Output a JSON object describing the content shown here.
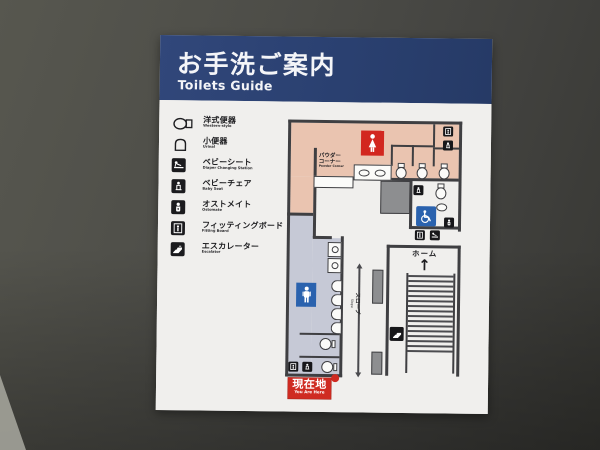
{
  "sign": {
    "title": "お手洗ご案内",
    "subtitle": "Toilets Guide"
  },
  "legend": {
    "items": [
      {
        "jp": "洋式便器",
        "en": "Western-style",
        "icon": "western-toilet-icon"
      },
      {
        "jp": "小便器",
        "en": "Urinal",
        "icon": "urinal-icon"
      },
      {
        "jp": "ベビーシート",
        "en": "Diaper Changing Station",
        "icon": "diaper-changing-icon"
      },
      {
        "jp": "ベビーチェア",
        "en": "Baby Seat",
        "icon": "baby-seat-icon"
      },
      {
        "jp": "オストメイト",
        "en": "Ostomate",
        "icon": "ostomate-icon"
      },
      {
        "jp": "フィッティングボード",
        "en": "Fitting Board",
        "icon": "fitting-board-icon"
      },
      {
        "jp": "エスカレーター",
        "en": "Escalator",
        "icon": "escalator-icon"
      }
    ]
  },
  "map": {
    "powder_corner": {
      "jp_line1": "パウダー",
      "jp_line2": "コーナー",
      "en": "Powder Corner"
    },
    "platform": {
      "label": "ホーム",
      "arrow": "↑"
    },
    "slope": {
      "jp": "スロープ",
      "en": "Slope"
    },
    "you_are_here": {
      "jp": "現在地",
      "en": "You Are Here"
    },
    "icons": [
      "female-icon",
      "male-icon",
      "wheelchair-icon",
      "escalator-icon",
      "diaper-changing-icon",
      "baby-seat-icon",
      "ostomate-icon",
      "fitting-board-icon",
      "you-are-here-dot"
    ]
  },
  "colors": {
    "header_bg": "#2a4070",
    "sign_bg": "#efeeec",
    "womens_area": "#eac4b0",
    "mens_area": "#c6c9d6",
    "womens_tile": "#d2271f",
    "mens_tile": "#2a62ae",
    "accessible_tile": "#2a62ae",
    "you_are_here": "#cf2b22",
    "wall_line": "#3f3f42",
    "photo_wall": "#4a4a46"
  }
}
